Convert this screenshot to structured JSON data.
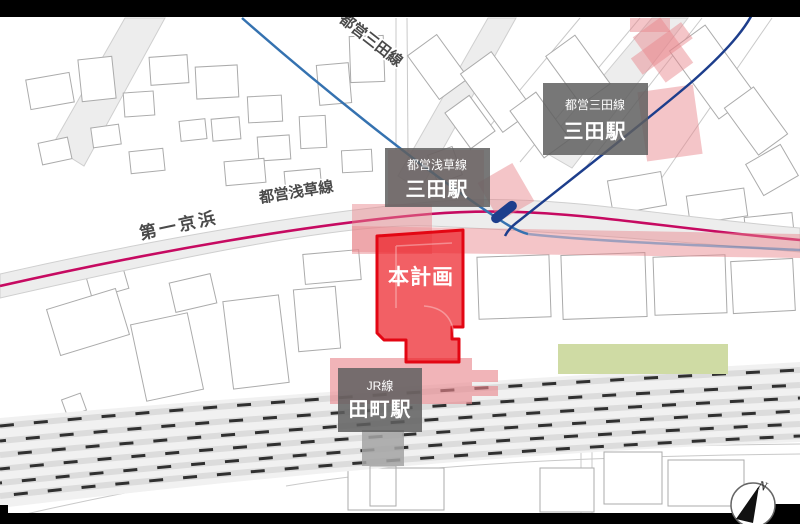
{
  "map": {
    "site_label": "本計画",
    "rotated_labels": {
      "toei_mita_line": "都営三田線",
      "toei_asakusa_line": "都営浅草線",
      "daiichi_keihin": "第一京浜"
    },
    "station_boxes": {
      "mita_subway": {
        "line": "都営三田線",
        "station": "三田駅"
      },
      "asakusa_subway": {
        "line": "都営浅草線",
        "station": "三田駅"
      },
      "jr_tamachi": {
        "line": "JR線",
        "station": "田町駅"
      }
    },
    "compass": {
      "north": "N"
    },
    "colors": {
      "site_red": "#ed1c24",
      "site_red_border": "#e30613",
      "highlight_pink": "#e8868d",
      "mita_line_blue": "#1d3e8c",
      "asakusa_line_blue": "#3572b0",
      "route15_magenta": "#c60a61",
      "park_green": "#cfdba4",
      "label_box_gray": "#5f5f5f"
    }
  }
}
